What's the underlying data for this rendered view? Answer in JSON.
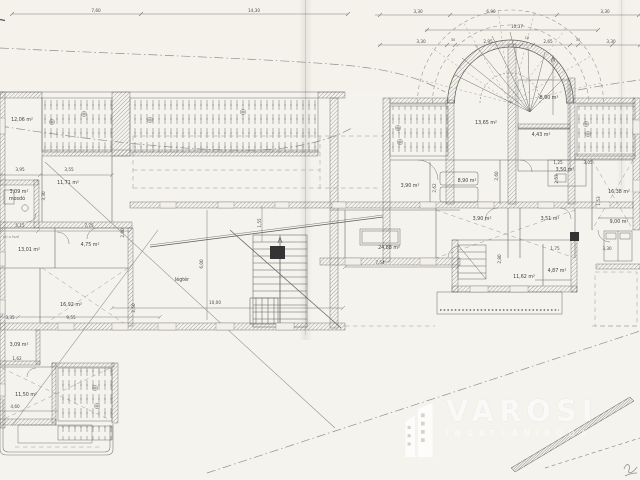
{
  "watermark": {
    "brand": "VÁROSI",
    "subtitle": "INGATLANIRODA",
    "logo": "buildings-icon"
  },
  "plan": {
    "room_labels": [
      {
        "text": "12,06 m²",
        "x": 22,
        "y": 121
      },
      {
        "text": "11,71 m²",
        "x": 68,
        "y": 184
      },
      {
        "text": "3,09 m²",
        "x": 19,
        "y": 193
      },
      {
        "text": "mosdó",
        "x": 17,
        "y": 200
      },
      {
        "text": "13,01 m²",
        "x": 29,
        "y": 251
      },
      {
        "text": "4,75 m²",
        "x": 90,
        "y": 246
      },
      {
        "text": "16,92 m²",
        "x": 71,
        "y": 306
      },
      {
        "text": "3,09 m²",
        "x": 19,
        "y": 346
      },
      {
        "text": "11,50 m²",
        "x": 26,
        "y": 396
      },
      {
        "text": "légtér",
        "x": 182,
        "y": 281
      },
      {
        "text": "13,65 m²",
        "x": 486,
        "y": 124
      },
      {
        "text": "8,90 m²",
        "x": 549,
        "y": 99
      },
      {
        "text": "4,43 m²",
        "x": 541,
        "y": 136
      },
      {
        "text": "8,90 m²",
        "x": 467,
        "y": 182
      },
      {
        "text": "3,50 m²",
        "x": 565,
        "y": 171
      },
      {
        "text": "3,90 m²",
        "x": 410,
        "y": 187
      },
      {
        "text": "3,90 m²",
        "x": 482,
        "y": 220
      },
      {
        "text": "3,51 m²",
        "x": 550,
        "y": 220
      },
      {
        "text": "16,38 m²",
        "x": 619,
        "y": 193
      },
      {
        "text": "9,00 m²",
        "x": 619,
        "y": 223
      },
      {
        "text": "24,88 m²",
        "x": 389,
        "y": 249
      },
      {
        "text": "11,62 m²",
        "x": 524,
        "y": 278
      },
      {
        "text": "4,87 m²",
        "x": 557,
        "y": 272
      }
    ],
    "dim_labels": [
      {
        "text": "7,60",
        "x": 96,
        "y": 12
      },
      {
        "text": "14,30",
        "x": 254,
        "y": 12
      },
      {
        "text": "3,30",
        "x": 418,
        "y": 13
      },
      {
        "text": "6,90",
        "x": 491,
        "y": 13
      },
      {
        "text": "3,30",
        "x": 605,
        "y": 13
      },
      {
        "text": "10,37",
        "x": 517,
        "y": 28
      },
      {
        "text": "3,30",
        "x": 421,
        "y": 43
      },
      {
        "text": "30",
        "x": 453,
        "y": 41,
        "size": "tiny"
      },
      {
        "text": "2,95",
        "x": 488,
        "y": 43
      },
      {
        "text": "10",
        "x": 527,
        "y": 39,
        "size": "tiny"
      },
      {
        "text": "2,65",
        "x": 548,
        "y": 43
      },
      {
        "text": "30",
        "x": 578,
        "y": 41,
        "size": "tiny"
      },
      {
        "text": "3,30",
        "x": 611,
        "y": 43
      },
      {
        "text": "3,95",
        "x": 20,
        "y": 171
      },
      {
        "text": "3,55",
        "x": 69,
        "y": 171
      },
      {
        "text": "3,30",
        "x": 45,
        "y": 196,
        "rot": -90
      },
      {
        "text": "5,15",
        "x": 20,
        "y": 227
      },
      {
        "text": "7,75",
        "x": 89,
        "y": 227
      },
      {
        "text": "2,80",
        "x": 124,
        "y": 233,
        "rot": -90
      },
      {
        "text": "2,50",
        "x": 135,
        "y": 308,
        "rot": -90
      },
      {
        "text": "3,35",
        "x": 10,
        "y": 319
      },
      {
        "text": "9,55",
        "x": 71,
        "y": 319
      },
      {
        "text": "1,62",
        "x": 17,
        "y": 360
      },
      {
        "text": "4,60",
        "x": 15,
        "y": 408
      },
      {
        "text": "6,00",
        "x": 203,
        "y": 264,
        "rot": -90
      },
      {
        "text": "10,00",
        "x": 215,
        "y": 304
      },
      {
        "text": "1,55",
        "x": 261,
        "y": 223,
        "rot": -90
      },
      {
        "text": "7,54",
        "x": 380,
        "y": 264
      },
      {
        "text": "1,25",
        "x": 558,
        "y": 164
      },
      {
        "text": "2,60",
        "x": 498,
        "y": 176,
        "rot": -90
      },
      {
        "text": "3,05",
        "x": 588,
        "y": 164
      },
      {
        "text": "2,53",
        "x": 558,
        "y": 179,
        "rot": -90
      },
      {
        "text": "1,53",
        "x": 600,
        "y": 201,
        "rot": -90
      },
      {
        "text": "2,62",
        "x": 436,
        "y": 188,
        "rot": -90
      },
      {
        "text": "1,75",
        "x": 555,
        "y": 250
      },
      {
        "text": "2,80",
        "x": 501,
        "y": 259,
        "rot": -90
      },
      {
        "text": "3,30",
        "x": 607,
        "y": 250
      }
    ],
    "note_labels": [
      {
        "text": "eti a fszé",
        "x": 11,
        "y": 238
      }
    ]
  }
}
